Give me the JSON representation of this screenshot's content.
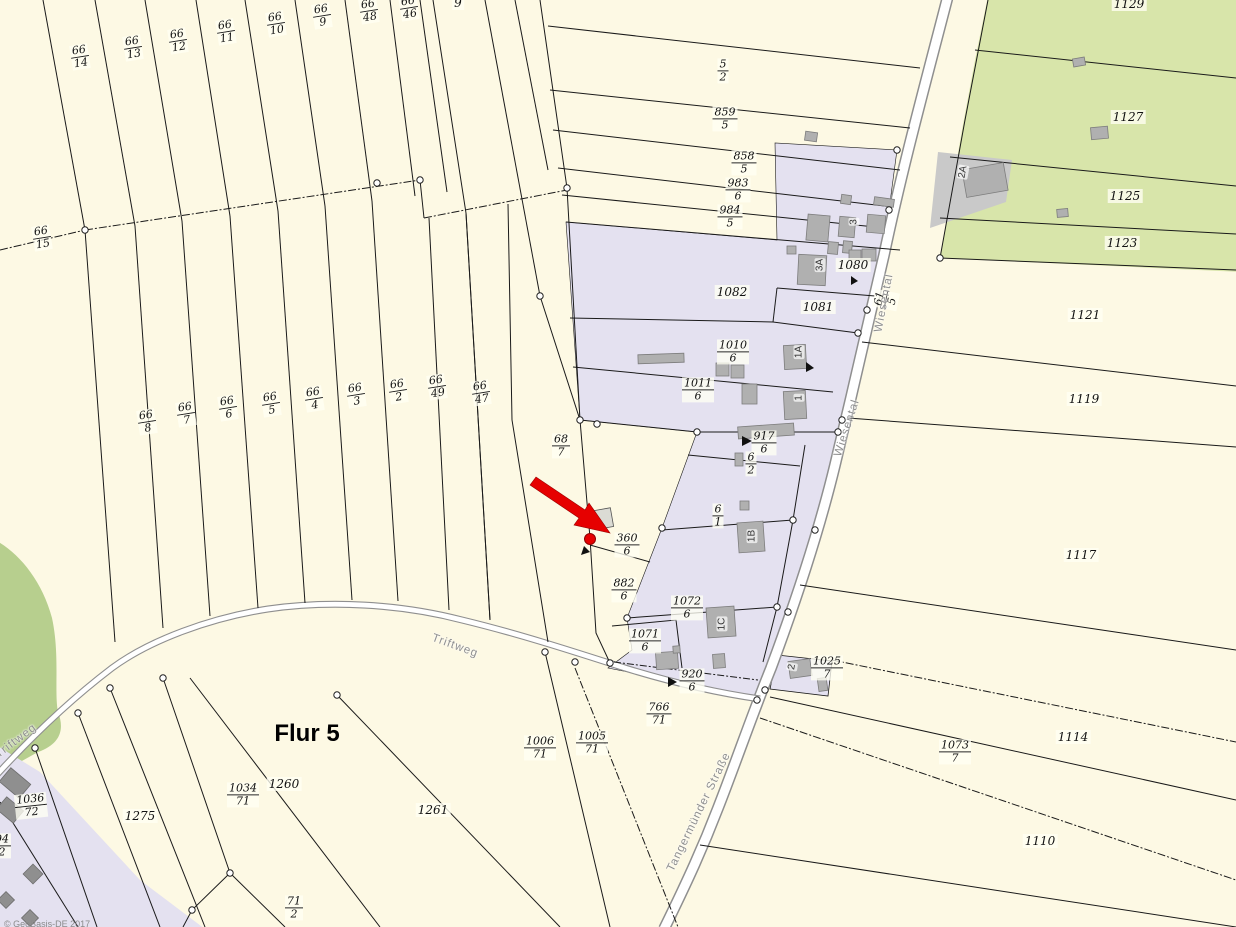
{
  "map": {
    "flur_label": "Flur 5",
    "copyright": "© GeoBasis-DE 2017",
    "colors": {
      "bg": "#fdf9e4",
      "built": "#e4e1f0",
      "green1": "#d8e5aa",
      "green2": "#b7cf8e",
      "bldg": "#b0b0b0",
      "bldg-stroke": "#7d7d7d",
      "bldg-dark": "#8f8f8f",
      "pave": "#c9c9c9",
      "road-fill": "#ffffff",
      "road-case": "#8f8f8f",
      "line": "#1a1a1a",
      "red": "#e60000",
      "road-label": "#8f8f8f"
    },
    "fraction_labels": [
      {
        "num": "66",
        "den": "14",
        "x": 80,
        "y": 57,
        "rot": -9
      },
      {
        "num": "66",
        "den": "13",
        "x": 133,
        "y": 48,
        "rot": -9
      },
      {
        "num": "66",
        "den": "12",
        "x": 178,
        "y": 41,
        "rot": -9
      },
      {
        "num": "66",
        "den": "11",
        "x": 226,
        "y": 32,
        "rot": -9
      },
      {
        "num": "66",
        "den": "10",
        "x": 276,
        "y": 24,
        "rot": -9
      },
      {
        "num": "66",
        "den": "9",
        "x": 322,
        "y": 16,
        "rot": -9
      },
      {
        "num": "66",
        "den": "48",
        "x": 369,
        "y": 11,
        "rot": -9
      },
      {
        "num": "66",
        "den": "46",
        "x": 409,
        "y": 8,
        "rot": -9
      },
      {
        "num": "66",
        "den": "15",
        "x": 42,
        "y": 238,
        "rot": -9
      },
      {
        "num": "66",
        "den": "8",
        "x": 147,
        "y": 422,
        "rot": -9
      },
      {
        "num": "66",
        "den": "7",
        "x": 186,
        "y": 414,
        "rot": -9
      },
      {
        "num": "66",
        "den": "6",
        "x": 228,
        "y": 408,
        "rot": -9
      },
      {
        "num": "66",
        "den": "5",
        "x": 271,
        "y": 404,
        "rot": -9
      },
      {
        "num": "66",
        "den": "4",
        "x": 314,
        "y": 399,
        "rot": -9
      },
      {
        "num": "66",
        "den": "3",
        "x": 356,
        "y": 395,
        "rot": -9
      },
      {
        "num": "66",
        "den": "2",
        "x": 398,
        "y": 391,
        "rot": -9
      },
      {
        "num": "66",
        "den": "49",
        "x": 437,
        "y": 387,
        "rot": -9
      },
      {
        "num": "66",
        "den": "47",
        "x": 481,
        "y": 393,
        "rot": -9
      },
      {
        "num": "5",
        "den": "2",
        "x": 723,
        "y": 71,
        "rot": 0
      },
      {
        "num": "859",
        "den": "5",
        "x": 725,
        "y": 119,
        "rot": 0
      },
      {
        "num": "858",
        "den": "5",
        "x": 744,
        "y": 163,
        "rot": 0
      },
      {
        "num": "983",
        "den": "6",
        "x": 738,
        "y": 190,
        "rot": 0
      },
      {
        "num": "984",
        "den": "5",
        "x": 730,
        "y": 217,
        "rot": 0
      },
      {
        "num": "1010",
        "den": "6",
        "x": 733,
        "y": 352,
        "rot": 0
      },
      {
        "num": "1011",
        "den": "6",
        "x": 698,
        "y": 390,
        "rot": 0
      },
      {
        "num": "917",
        "den": "6",
        "x": 764,
        "y": 443,
        "rot": 0
      },
      {
        "num": "6",
        "den": "2",
        "x": 751,
        "y": 464,
        "rot": 0
      },
      {
        "num": "6",
        "den": "1",
        "x": 718,
        "y": 516,
        "rot": 0
      },
      {
        "num": "68",
        "den": "7",
        "x": 561,
        "y": 446,
        "rot": 0
      },
      {
        "num": "360",
        "den": "6",
        "x": 627,
        "y": 545,
        "rot": 0
      },
      {
        "num": "882",
        "den": "6",
        "x": 624,
        "y": 590,
        "rot": 0
      },
      {
        "num": "1072",
        "den": "6",
        "x": 687,
        "y": 608,
        "rot": 0
      },
      {
        "num": "1071",
        "den": "6",
        "x": 645,
        "y": 641,
        "rot": 0
      },
      {
        "num": "920",
        "den": "6",
        "x": 692,
        "y": 681,
        "rot": 0
      },
      {
        "num": "766",
        "den": "71",
        "x": 659,
        "y": 714,
        "rot": 0
      },
      {
        "num": "1005",
        "den": "71",
        "x": 592,
        "y": 743,
        "rot": 0
      },
      {
        "num": "1006",
        "den": "71",
        "x": 540,
        "y": 748,
        "rot": 0
      },
      {
        "num": "1034",
        "den": "71",
        "x": 243,
        "y": 795,
        "rot": 0
      },
      {
        "num": "71",
        "den": "2",
        "x": 294,
        "y": 908,
        "rot": 0
      },
      {
        "num": "1036",
        "den": "72",
        "x": 31,
        "y": 806,
        "rot": -6
      },
      {
        "num": "94",
        "den": "2",
        "x": 2,
        "y": 846,
        "rot": 0
      },
      {
        "num": "1073",
        "den": "7",
        "x": 955,
        "y": 752,
        "rot": 0
      },
      {
        "num": "1025",
        "den": "7",
        "x": 827,
        "y": 668,
        "rot": 0
      },
      {
        "num": "61",
        "den": "5",
        "x": 886,
        "y": 300,
        "rot": -78
      }
    ],
    "plain_labels": [
      {
        "text": "9",
        "x": 458,
        "y": 3
      },
      {
        "text": "1082",
        "x": 732,
        "y": 292
      },
      {
        "text": "1081",
        "x": 818,
        "y": 307
      },
      {
        "text": "1080",
        "x": 853,
        "y": 265
      },
      {
        "text": "1129",
        "x": 1129,
        "y": 4
      },
      {
        "text": "1127",
        "x": 1128,
        "y": 117
      },
      {
        "text": "1125",
        "x": 1125,
        "y": 196
      },
      {
        "text": "1123",
        "x": 1122,
        "y": 243
      },
      {
        "text": "1121",
        "x": 1085,
        "y": 315
      },
      {
        "text": "1119",
        "x": 1084,
        "y": 399
      },
      {
        "text": "1117",
        "x": 1081,
        "y": 555
      },
      {
        "text": "1114",
        "x": 1073,
        "y": 737
      },
      {
        "text": "1110",
        "x": 1040,
        "y": 841
      },
      {
        "text": "1260",
        "x": 284,
        "y": 784
      },
      {
        "text": "1275",
        "x": 140,
        "y": 816
      },
      {
        "text": "1261",
        "x": 433,
        "y": 810
      }
    ],
    "road_labels": [
      {
        "text": "Triftweg",
        "x": 455,
        "y": 646,
        "rot": 20
      },
      {
        "text": "Triftweg",
        "x": 16,
        "y": 741,
        "rot": -37
      },
      {
        "text": "Tangermünder Straße",
        "x": 699,
        "y": 812,
        "rot": -64
      },
      {
        "text": "Wiesental",
        "x": 884,
        "y": 303,
        "rot": -79
      },
      {
        "text": "Wiesental",
        "x": 847,
        "y": 428,
        "rot": -72
      }
    ],
    "building_labels": [
      {
        "text": "2A",
        "x": 963,
        "y": 172,
        "rot": -80
      },
      {
        "text": "3",
        "x": 854,
        "y": 222,
        "rot": -90
      },
      {
        "text": "3A",
        "x": 820,
        "y": 265,
        "rot": -90
      },
      {
        "text": "1A",
        "x": 799,
        "y": 352,
        "rot": -90
      },
      {
        "text": "1",
        "x": 799,
        "y": 398,
        "rot": -90
      },
      {
        "text": "1B",
        "x": 752,
        "y": 536,
        "rot": -90
      },
      {
        "text": "1C",
        "x": 722,
        "y": 624,
        "rot": -90
      },
      {
        "text": "2",
        "x": 792,
        "y": 667,
        "rot": -80
      }
    ]
  }
}
